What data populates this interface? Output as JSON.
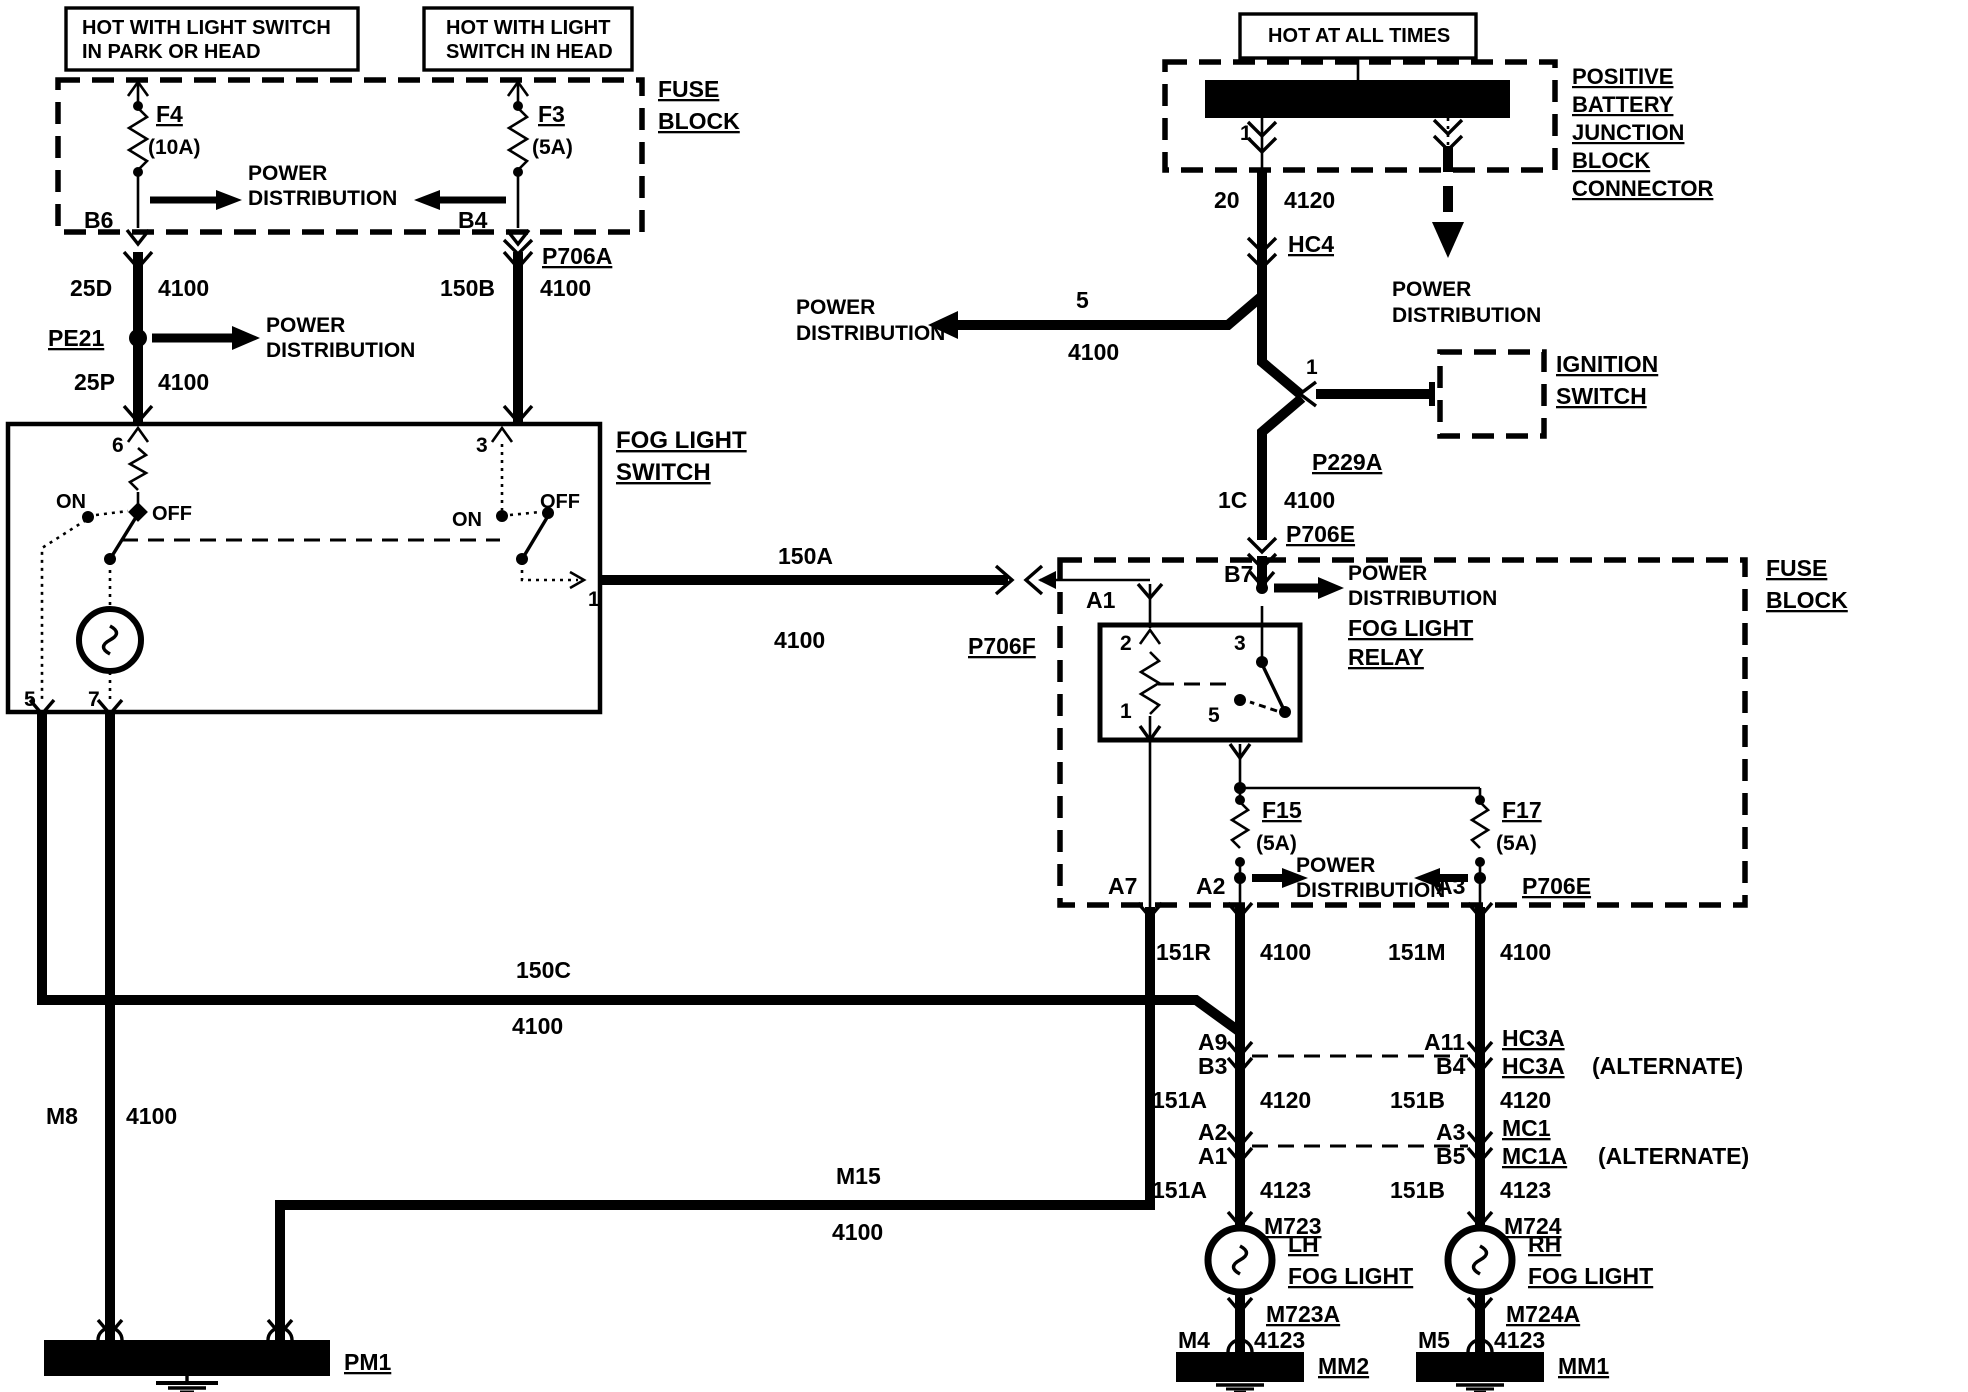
{
  "colors": {
    "ink": "#000000",
    "paper": "#ffffff"
  },
  "labels": [
    {
      "id": "note-park-head-line1",
      "t": "HOT WITH LIGHT SWITCH",
      "x": 82,
      "y": 34,
      "s": 20
    },
    {
      "id": "note-park-head-line2",
      "t": "IN PARK OR HEAD",
      "x": 82,
      "y": 58,
      "s": 20
    },
    {
      "id": "note-head-line1",
      "t": "HOT WITH LIGHT",
      "x": 446,
      "y": 34,
      "s": 20
    },
    {
      "id": "note-head-line2",
      "t": "SWITCH IN HEAD",
      "x": 446,
      "y": 58,
      "s": 20
    },
    {
      "id": "note-hot-all-times",
      "t": "HOT AT ALL TIMES",
      "x": 1268,
      "y": 42,
      "s": 20
    },
    {
      "id": "fuse-f4",
      "t": "F4",
      "x": 156,
      "y": 122,
      "s": 23,
      "u": true
    },
    {
      "id": "fuse-f4-rating",
      "t": "(10A)",
      "x": 148,
      "y": 154,
      "s": 21
    },
    {
      "id": "fuse-f3",
      "t": "F3",
      "x": 538,
      "y": 122,
      "s": 23,
      "u": true
    },
    {
      "id": "fuse-f3-rating",
      "t": "(5A)",
      "x": 532,
      "y": 154,
      "s": 21
    },
    {
      "id": "power-dist-1-line1",
      "t": "POWER",
      "x": 248,
      "y": 180,
      "s": 21
    },
    {
      "id": "power-dist-1-line2",
      "t": "DISTRIBUTION",
      "x": 248,
      "y": 205,
      "s": 21
    },
    {
      "id": "pin-b6",
      "t": "B6",
      "x": 84,
      "y": 228,
      "s": 23
    },
    {
      "id": "pin-b4",
      "t": "B4",
      "x": 458,
      "y": 228,
      "s": 23
    },
    {
      "id": "fuse-block-1-line1",
      "t": "FUSE",
      "x": 658,
      "y": 97,
      "s": 23,
      "u": true
    },
    {
      "id": "fuse-block-1-line2",
      "t": "BLOCK",
      "x": 658,
      "y": 129,
      "s": 23,
      "u": true
    },
    {
      "id": "conn-p706a",
      "t": "P706A",
      "x": 542,
      "y": 264,
      "s": 23,
      "u": true
    },
    {
      "id": "wire-25d",
      "t": "25D",
      "x": 70,
      "y": 296,
      "s": 23
    },
    {
      "id": "wire-25d-4100",
      "t": "4100",
      "x": 158,
      "y": 296,
      "s": 23
    },
    {
      "id": "wire-150b",
      "t": "150B",
      "x": 440,
      "y": 296,
      "s": 23
    },
    {
      "id": "wire-150b-4100",
      "t": "4100",
      "x": 540,
      "y": 296,
      "s": 23
    },
    {
      "id": "conn-pe21",
      "t": "PE21",
      "x": 48,
      "y": 346,
      "s": 23,
      "u": true
    },
    {
      "id": "power-dist-2-line1",
      "t": "POWER",
      "x": 266,
      "y": 332,
      "s": 21
    },
    {
      "id": "power-dist-2-line2",
      "t": "DISTRIBUTION",
      "x": 266,
      "y": 357,
      "s": 21
    },
    {
      "id": "wire-25p",
      "t": "25P",
      "x": 74,
      "y": 390,
      "s": 23
    },
    {
      "id": "wire-25p-4100",
      "t": "4100",
      "x": 158,
      "y": 390,
      "s": 23
    },
    {
      "id": "fog-light-switch-line1",
      "t": "FOG LIGHT",
      "x": 616,
      "y": 448,
      "s": 24,
      "u": true
    },
    {
      "id": "fog-light-switch-line2",
      "t": "SWITCH",
      "x": 616,
      "y": 480,
      "s": 24,
      "u": true
    },
    {
      "id": "switch-pin6",
      "t": "6",
      "x": 112,
      "y": 452,
      "s": 21
    },
    {
      "id": "switch-on-left",
      "t": "ON",
      "x": 56,
      "y": 508,
      "s": 20
    },
    {
      "id": "switch-off-left",
      "t": "OFF",
      "x": 152,
      "y": 520,
      "s": 20
    },
    {
      "id": "switch-pin3",
      "t": "3",
      "x": 476,
      "y": 452,
      "s": 21
    },
    {
      "id": "switch-on-right",
      "t": "ON",
      "x": 452,
      "y": 526,
      "s": 20
    },
    {
      "id": "switch-off-right",
      "t": "OFF",
      "x": 540,
      "y": 508,
      "s": 20
    },
    {
      "id": "switch-pin5",
      "t": "5",
      "x": 24,
      "y": 706,
      "s": 21
    },
    {
      "id": "switch-pin7",
      "t": "7",
      "x": 88,
      "y": 706,
      "s": 21
    },
    {
      "id": "switch-pin1",
      "t": "1",
      "x": 588,
      "y": 606,
      "s": 21
    },
    {
      "id": "wire-150a",
      "t": "150A",
      "x": 778,
      "y": 564,
      "s": 23
    },
    {
      "id": "wire-150a-4100",
      "t": "4100",
      "x": 774,
      "y": 648,
      "s": 23
    },
    {
      "id": "conn-p706f",
      "t": "P706F",
      "x": 968,
      "y": 654,
      "s": 23,
      "u": true
    },
    {
      "id": "pin-a1",
      "t": "A1",
      "x": 1086,
      "y": 608,
      "s": 23
    },
    {
      "id": "battery-label-line1",
      "t": "POSITIVE",
      "x": 1572,
      "y": 84,
      "s": 22,
      "u": true
    },
    {
      "id": "battery-label-line2",
      "t": "BATTERY",
      "x": 1572,
      "y": 112,
      "s": 22,
      "u": true
    },
    {
      "id": "battery-label-line3",
      "t": "JUNCTION",
      "x": 1572,
      "y": 140,
      "s": 22,
      "u": true
    },
    {
      "id": "battery-label-line4",
      "t": "BLOCK",
      "x": 1572,
      "y": 168,
      "s": 22,
      "u": true
    },
    {
      "id": "battery-label-line5",
      "t": "CONNECTOR",
      "x": 1572,
      "y": 196,
      "s": 22,
      "u": true
    },
    {
      "id": "battery-pin1",
      "t": "1",
      "x": 1240,
      "y": 140,
      "s": 21
    },
    {
      "id": "wire-20",
      "t": "20",
      "x": 1214,
      "y": 208,
      "s": 23
    },
    {
      "id": "wire-4120",
      "t": "4120",
      "x": 1284,
      "y": 208,
      "s": 23
    },
    {
      "id": "conn-hc4",
      "t": "HC4",
      "x": 1288,
      "y": 252,
      "s": 23,
      "u": true
    },
    {
      "id": "wire-5",
      "t": "5",
      "x": 1076,
      "y": 308,
      "s": 23
    },
    {
      "id": "wire-5-4100",
      "t": "4100",
      "x": 1068,
      "y": 360,
      "s": 23
    },
    {
      "id": "power-dist-3-line1",
      "t": "POWER",
      "x": 796,
      "y": 314,
      "s": 21
    },
    {
      "id": "power-dist-3-line2",
      "t": "DISTRIBUTION",
      "x": 796,
      "y": 340,
      "s": 21
    },
    {
      "id": "power-dist-4-line1",
      "t": "POWER",
      "x": 1392,
      "y": 296,
      "s": 21
    },
    {
      "id": "power-dist-4-line2",
      "t": "DISTRIBUTION",
      "x": 1392,
      "y": 322,
      "s": 21
    },
    {
      "id": "ignition-pin1",
      "t": "1",
      "x": 1306,
      "y": 374,
      "s": 21
    },
    {
      "id": "conn-p229a",
      "t": "P229A",
      "x": 1312,
      "y": 470,
      "s": 23,
      "u": true
    },
    {
      "id": "ignition-switch-line1",
      "t": "IGNITION",
      "x": 1556,
      "y": 372,
      "s": 23,
      "u": true
    },
    {
      "id": "ignition-switch-line2",
      "t": "SWITCH",
      "x": 1556,
      "y": 404,
      "s": 23,
      "u": true
    },
    {
      "id": "wire-1c",
      "t": "1C",
      "x": 1218,
      "y": 508,
      "s": 23
    },
    {
      "id": "wire-1c-4100",
      "t": "4100",
      "x": 1284,
      "y": 508,
      "s": 23
    },
    {
      "id": "conn-p706e",
      "t": "P706E",
      "x": 1286,
      "y": 542,
      "s": 23,
      "u": true
    },
    {
      "id": "fuse-block-2-line1",
      "t": "FUSE",
      "x": 1766,
      "y": 576,
      "s": 23,
      "u": true
    },
    {
      "id": "fuse-block-2-line2",
      "t": "BLOCK",
      "x": 1766,
      "y": 608,
      "s": 23,
      "u": true
    },
    {
      "id": "pin-b7",
      "t": "B7",
      "x": 1224,
      "y": 582,
      "s": 23
    },
    {
      "id": "power-dist-5-line1",
      "t": "POWER",
      "x": 1348,
      "y": 580,
      "s": 21
    },
    {
      "id": "power-dist-5-line2",
      "t": "DISTRIBUTION",
      "x": 1348,
      "y": 605,
      "s": 21
    },
    {
      "id": "fog-light-relay-line1",
      "t": "FOG LIGHT",
      "x": 1348,
      "y": 636,
      "s": 23,
      "u": true
    },
    {
      "id": "fog-light-relay-line2",
      "t": "RELAY",
      "x": 1348,
      "y": 665,
      "s": 23,
      "u": true
    },
    {
      "id": "relay-pin2",
      "t": "2",
      "x": 1120,
      "y": 650,
      "s": 21
    },
    {
      "id": "relay-pin1",
      "t": "1",
      "x": 1120,
      "y": 718,
      "s": 21
    },
    {
      "id": "relay-pin3",
      "t": "3",
      "x": 1234,
      "y": 650,
      "s": 21
    },
    {
      "id": "relay-pin5",
      "t": "5",
      "x": 1208,
      "y": 722,
      "s": 21
    },
    {
      "id": "fuse-f15",
      "t": "F15",
      "x": 1262,
      "y": 818,
      "s": 23,
      "u": true
    },
    {
      "id": "fuse-f15-rating",
      "t": "(5A)",
      "x": 1256,
      "y": 850,
      "s": 21
    },
    {
      "id": "fuse-f17",
      "t": "F17",
      "x": 1502,
      "y": 818,
      "s": 23,
      "u": true
    },
    {
      "id": "fuse-f17-rating",
      "t": "(5A)",
      "x": 1496,
      "y": 850,
      "s": 21
    },
    {
      "id": "power-dist-6-line1",
      "t": "POWER",
      "x": 1296,
      "y": 872,
      "s": 21
    },
    {
      "id": "power-dist-6-line2",
      "t": "DISTRIBUTION",
      "x": 1296,
      "y": 897,
      "s": 21
    },
    {
      "id": "pin-a7",
      "t": "A7",
      "x": 1108,
      "y": 894,
      "s": 23
    },
    {
      "id": "pin-a2",
      "t": "A2",
      "x": 1196,
      "y": 894,
      "s": 23
    },
    {
      "id": "pin-a3",
      "t": "A3",
      "x": 1436,
      "y": 894,
      "s": 23
    },
    {
      "id": "conn-p706e-2",
      "t": "P706E",
      "x": 1522,
      "y": 894,
      "s": 23,
      "u": true
    },
    {
      "id": "wire-150c",
      "t": "150C",
      "x": 516,
      "y": 978,
      "s": 23
    },
    {
      "id": "wire-150c-4100",
      "t": "4100",
      "x": 512,
      "y": 1034,
      "s": 23
    },
    {
      "id": "wire-151r",
      "t": "151R",
      "x": 1156,
      "y": 960,
      "s": 23
    },
    {
      "id": "wire-151r-4100",
      "t": "4100",
      "x": 1260,
      "y": 960,
      "s": 23
    },
    {
      "id": "wire-151m",
      "t": "151M",
      "x": 1388,
      "y": 960,
      "s": 23
    },
    {
      "id": "wire-151m-4100",
      "t": "4100",
      "x": 1500,
      "y": 960,
      "s": 23
    },
    {
      "id": "wire-m8",
      "t": "M8",
      "x": 46,
      "y": 1124,
      "s": 23
    },
    {
      "id": "wire-m8-4100",
      "t": "4100",
      "x": 126,
      "y": 1124,
      "s": 23
    },
    {
      "id": "pin-a9",
      "t": "A9",
      "x": 1198,
      "y": 1050,
      "s": 23
    },
    {
      "id": "pin-b3",
      "t": "B3",
      "x": 1198,
      "y": 1074,
      "s": 23
    },
    {
      "id": "pin-a11",
      "t": "A11",
      "x": 1424,
      "y": 1050,
      "s": 23
    },
    {
      "id": "pin-b4-2",
      "t": "B4",
      "x": 1436,
      "y": 1074,
      "s": 23
    },
    {
      "id": "conn-hc3a-1",
      "t": "HC3A",
      "x": 1502,
      "y": 1046,
      "s": 23,
      "u": true
    },
    {
      "id": "conn-hc3a-2",
      "t": "HC3A",
      "x": 1502,
      "y": 1074,
      "s": 23,
      "u": true
    },
    {
      "id": "alternate-1",
      "t": "(ALTERNATE)",
      "x": 1592,
      "y": 1074,
      "s": 23
    },
    {
      "id": "wire-151a-1",
      "t": "151A",
      "x": 1152,
      "y": 1108,
      "s": 23
    },
    {
      "id": "wire-4120-2",
      "t": "4120",
      "x": 1260,
      "y": 1108,
      "s": 23
    },
    {
      "id": "wire-151b-1",
      "t": "151B",
      "x": 1390,
      "y": 1108,
      "s": 23
    },
    {
      "id": "wire-4120-3",
      "t": "4120",
      "x": 1500,
      "y": 1108,
      "s": 23
    },
    {
      "id": "pin-a2-2",
      "t": "A2",
      "x": 1198,
      "y": 1140,
      "s": 23
    },
    {
      "id": "pin-a1-2",
      "t": "A1",
      "x": 1198,
      "y": 1164,
      "s": 23
    },
    {
      "id": "pin-a3-2",
      "t": "A3",
      "x": 1436,
      "y": 1140,
      "s": 23
    },
    {
      "id": "pin-b5",
      "t": "B5",
      "x": 1436,
      "y": 1164,
      "s": 23
    },
    {
      "id": "conn-mc1",
      "t": "MC1",
      "x": 1502,
      "y": 1136,
      "s": 23,
      "u": true
    },
    {
      "id": "conn-mc1a",
      "t": "MC1A",
      "x": 1502,
      "y": 1164,
      "s": 23,
      "u": true
    },
    {
      "id": "alternate-2",
      "t": "(ALTERNATE)",
      "x": 1598,
      "y": 1164,
      "s": 23
    },
    {
      "id": "wire-m15",
      "t": "M15",
      "x": 836,
      "y": 1184,
      "s": 23
    },
    {
      "id": "wire-m15-4100",
      "t": "4100",
      "x": 832,
      "y": 1240,
      "s": 23
    },
    {
      "id": "wire-151a-2",
      "t": "151A",
      "x": 1152,
      "y": 1198,
      "s": 23
    },
    {
      "id": "wire-4123-1",
      "t": "4123",
      "x": 1260,
      "y": 1198,
      "s": 23
    },
    {
      "id": "wire-151b-2",
      "t": "151B",
      "x": 1390,
      "y": 1198,
      "s": 23
    },
    {
      "id": "wire-4123-2",
      "t": "4123",
      "x": 1500,
      "y": 1198,
      "s": 23
    },
    {
      "id": "conn-m723",
      "t": "M723",
      "x": 1264,
      "y": 1234,
      "s": 23,
      "u": true
    },
    {
      "id": "conn-m724",
      "t": "M724",
      "x": 1504,
      "y": 1234,
      "s": 23,
      "u": true
    },
    {
      "id": "lh-fog-light-line1",
      "t": "LH",
      "x": 1288,
      "y": 1252,
      "s": 23,
      "u": true
    },
    {
      "id": "lh-fog-light-line2",
      "t": "FOG LIGHT",
      "x": 1288,
      "y": 1284,
      "s": 23,
      "u": true
    },
    {
      "id": "rh-fog-light-line1",
      "t": "RH",
      "x": 1528,
      "y": 1252,
      "s": 23,
      "u": true
    },
    {
      "id": "rh-fog-light-line2",
      "t": "FOG LIGHT",
      "x": 1528,
      "y": 1284,
      "s": 23,
      "u": true
    },
    {
      "id": "conn-m723a",
      "t": "M723A",
      "x": 1266,
      "y": 1322,
      "s": 23,
      "u": true
    },
    {
      "id": "conn-m724a",
      "t": "M724A",
      "x": 1506,
      "y": 1322,
      "s": 23,
      "u": true
    },
    {
      "id": "wire-m4",
      "t": "M4",
      "x": 1178,
      "y": 1348,
      "s": 23
    },
    {
      "id": "wire-m4-4123",
      "t": "4123",
      "x": 1254,
      "y": 1348,
      "s": 23
    },
    {
      "id": "wire-m5",
      "t": "M5",
      "x": 1418,
      "y": 1348,
      "s": 23
    },
    {
      "id": "wire-m5-4123",
      "t": "4123",
      "x": 1494,
      "y": 1348,
      "s": 23
    },
    {
      "id": "ground-pm1",
      "t": "PM1",
      "x": 344,
      "y": 1370,
      "s": 23,
      "u": true
    },
    {
      "id": "ground-mm2",
      "t": "MM2",
      "x": 1318,
      "y": 1374,
      "s": 23,
      "u": true
    },
    {
      "id": "ground-mm1",
      "t": "MM1",
      "x": 1558,
      "y": 1374,
      "s": 23,
      "u": true
    }
  ]
}
